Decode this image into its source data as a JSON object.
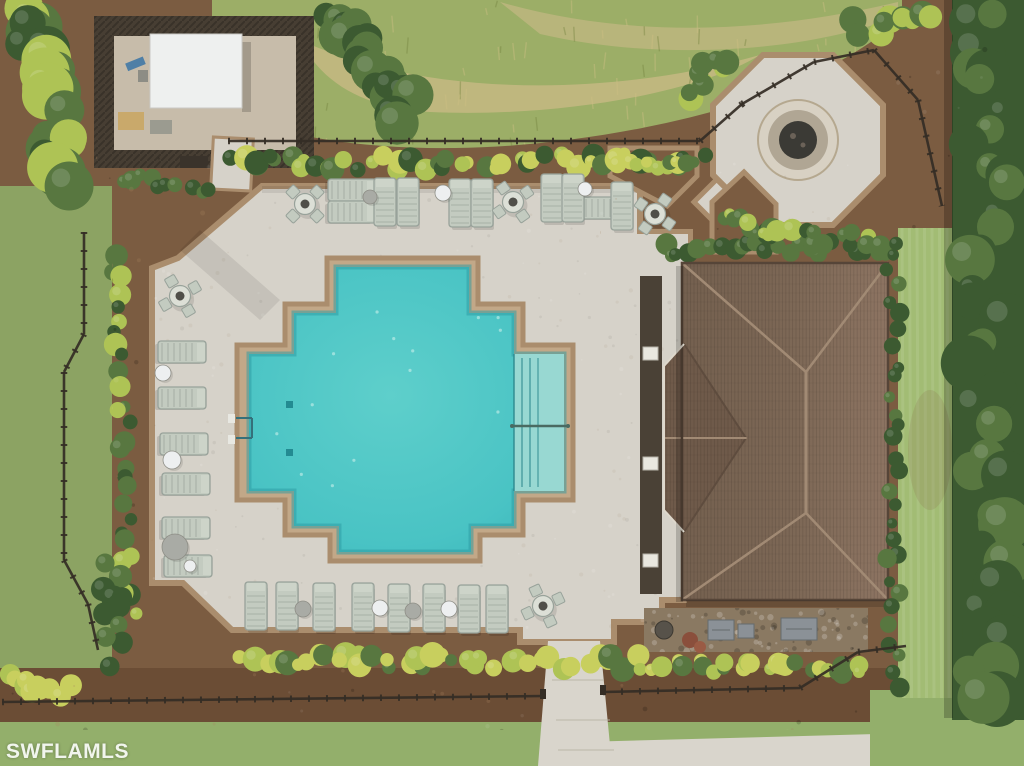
{
  "watermark": {
    "text": "SWFLAMLS"
  },
  "palette": {
    "mulch": "#7b5c41",
    "mulchDark": "#6b4d35",
    "grassField": "#9cae67",
    "grassBand": "#c8b985",
    "lawn": "#a2bc74",
    "grassBottom": "#93af6b",
    "leftGrass": "#8ca363",
    "hedgeDark": "#3c5a31",
    "hedgeMid": "#587740",
    "shrubBright": "#aec355",
    "shrubYellow": "#c8cf5e",
    "deck": "#d6d2c9",
    "deckBorder": "#aa8d6d",
    "coping": "#c2a888",
    "walk": "#d9d5cc",
    "water": "#46c0c2",
    "waterLight": "#5ecfcb",
    "waterDeep": "#3fbcbf",
    "waterEdge": "#2b9aa2",
    "steps": "#98d8d2",
    "roofL": "#75604f",
    "roofR": "#8d7462",
    "roofWing": "#6f5a4a",
    "roofLine": "#a18a74",
    "roofShadow": "#564538",
    "fence": "#342d25",
    "frame": "#98a29a",
    "slat": "#c3cbc0",
    "white": "#edeff0",
    "grayDisc": "#a9aba5",
    "gravel": "#c7bcaa",
    "enclosureFence": "#473e33",
    "structure": "#eef0ef",
    "rock": "#8a7962",
    "ac": "#8b9197",
    "firepitRing": "#d8d1c3",
    "firepitInner": "#3b3a35"
  },
  "palmColors": {
    "bright": [
      "#bcc959",
      "#96ad48"
    ],
    "mid": [
      "#8fae4c",
      "#6f9040"
    ],
    "dark": [
      "#70903f",
      "#587736"
    ]
  },
  "scene": {
    "leftLoungers": [
      {
        "x": 182,
        "y": 352
      },
      {
        "x": 182,
        "y": 398
      },
      {
        "x": 184,
        "y": 444
      },
      {
        "x": 186,
        "y": 484
      },
      {
        "x": 186,
        "y": 528
      },
      {
        "x": 188,
        "y": 566
      }
    ],
    "topLoungersH": [
      {
        "x": 352,
        "y": 190
      },
      {
        "x": 352,
        "y": 212
      },
      {
        "x": 600,
        "y": 208
      }
    ],
    "topLoungersV": [
      {
        "x": 385,
        "y": 202
      },
      {
        "x": 408,
        "y": 202
      },
      {
        "x": 460,
        "y": 203
      },
      {
        "x": 482,
        "y": 203
      },
      {
        "x": 552,
        "y": 198
      },
      {
        "x": 573,
        "y": 198
      },
      {
        "x": 622,
        "y": 206
      }
    ],
    "bottomLoungers": [
      {
        "x": 256,
        "y": 606
      },
      {
        "x": 287,
        "y": 606
      },
      {
        "x": 324,
        "y": 607
      },
      {
        "x": 363,
        "y": 607
      },
      {
        "x": 399,
        "y": 608
      },
      {
        "x": 434,
        "y": 608
      },
      {
        "x": 469,
        "y": 609
      },
      {
        "x": 497,
        "y": 609
      }
    ],
    "tableSets": [
      {
        "x": 180,
        "y": 296,
        "rot": 15
      },
      {
        "x": 305,
        "y": 204,
        "rot": 0
      },
      {
        "x": 513,
        "y": 202,
        "rot": 10
      },
      {
        "x": 655,
        "y": 214,
        "rot": -10
      },
      {
        "x": 543,
        "y": 606,
        "rot": 20
      }
    ],
    "discs": [
      {
        "x": 163,
        "y": 373,
        "r": 8,
        "c": "white"
      },
      {
        "x": 172,
        "y": 460,
        "r": 9,
        "c": "white"
      },
      {
        "x": 175,
        "y": 547,
        "r": 13,
        "c": "gray"
      },
      {
        "x": 370,
        "y": 197,
        "r": 7,
        "c": "gray"
      },
      {
        "x": 443,
        "y": 193,
        "r": 8,
        "c": "white"
      },
      {
        "x": 585,
        "y": 189,
        "r": 7,
        "c": "white"
      },
      {
        "x": 303,
        "y": 609,
        "r": 8,
        "c": "gray"
      },
      {
        "x": 380,
        "y": 608,
        "r": 8,
        "c": "white"
      },
      {
        "x": 413,
        "y": 611,
        "r": 8,
        "c": "gray"
      },
      {
        "x": 449,
        "y": 609,
        "r": 8,
        "c": "white"
      },
      {
        "x": 190,
        "y": 566,
        "r": 6,
        "c": "white"
      }
    ],
    "trash": [
      {
        "x": 243,
        "y": 182,
        "r": 9
      }
    ],
    "coolerBox": {
      "x": 174,
      "y": 608,
      "w": 13,
      "h": 13,
      "rot": 12
    },
    "firePit": {
      "cx": 798,
      "cy": 140,
      "chairs": [
        {
          "x": 768,
          "y": 102
        },
        {
          "x": 812,
          "y": 106
        },
        {
          "x": 748,
          "y": 131
        },
        {
          "x": 833,
          "y": 151
        },
        {
          "x": 760,
          "y": 168
        },
        {
          "x": 793,
          "y": 180
        }
      ]
    },
    "palms": [
      {
        "x": 40,
        "y": 70,
        "r": 115,
        "n": 10,
        "a0": -30,
        "a1": 140,
        "c": "bright"
      },
      {
        "x": 310,
        "y": 58,
        "r": 68,
        "n": 11,
        "c": "mid"
      },
      {
        "x": 468,
        "y": 60,
        "r": 72,
        "n": 11,
        "c": "mid"
      },
      {
        "x": 643,
        "y": 80,
        "r": 55,
        "n": 10,
        "c": "mid"
      },
      {
        "x": 405,
        "y": 100,
        "r": 38,
        "n": 8,
        "c": "bright"
      },
      {
        "x": 40,
        "y": 428,
        "r": 46,
        "n": 9,
        "c": "bright"
      },
      {
        "x": 90,
        "y": 436,
        "r": 40,
        "n": 8,
        "c": "mid"
      },
      {
        "x": 195,
        "y": 652,
        "r": 150,
        "n": 13,
        "c": "bright"
      },
      {
        "x": 610,
        "y": 760,
        "r": 135,
        "n": 9,
        "a0": 185,
        "a1": 355,
        "c": "bright"
      },
      {
        "x": 935,
        "y": 60,
        "r": 85,
        "n": 10,
        "c": "mid"
      },
      {
        "x": 1000,
        "y": 150,
        "r": 55,
        "n": 8,
        "c": "bright"
      },
      {
        "x": 870,
        "y": 20,
        "r": 55,
        "n": 8,
        "a0": 0,
        "a1": 200,
        "c": "bright"
      },
      {
        "x": 718,
        "y": 212,
        "r": 58,
        "n": 9,
        "c": "bright"
      },
      {
        "x": 962,
        "y": 330,
        "r": 48,
        "n": 9,
        "c": "dark"
      },
      {
        "x": 905,
        "y": 612,
        "r": 58,
        "n": 10,
        "c": "dark"
      },
      {
        "x": 963,
        "y": 690,
        "r": 72,
        "n": 11,
        "c": "mid"
      },
      {
        "x": 845,
        "y": 695,
        "r": 55,
        "n": 9,
        "c": "dark"
      },
      {
        "x": 700,
        "y": 706,
        "r": 60,
        "n": 9,
        "c": "mid"
      }
    ],
    "poolMarkers": [
      {
        "x": 402,
        "y": 262
      },
      {
        "x": 438,
        "y": 262
      },
      {
        "x": 302,
        "y": 309
      },
      {
        "x": 521,
        "y": 309
      },
      {
        "x": 248,
        "y": 358,
        "v": true
      },
      {
        "x": 248,
        "y": 489,
        "v": true
      },
      {
        "x": 568,
        "y": 357,
        "v": true
      },
      {
        "x": 568,
        "y": 489,
        "v": true
      },
      {
        "x": 326,
        "y": 556
      },
      {
        "x": 470,
        "y": 556
      }
    ],
    "hedgeRows": [
      {
        "layer": "deckEdge",
        "x1": 228,
        "y1": 164,
        "x2": 700,
        "y2": 160,
        "n": 48,
        "rmin": 6,
        "rmax": 13,
        "cols": [
          "bright",
          "mid",
          "dark",
          "yellow"
        ]
      },
      {
        "layer": "south",
        "x1": 238,
        "y1": 660,
        "x2": 642,
        "y2": 663,
        "n": 42,
        "rmin": 6,
        "rmax": 13,
        "cols": [
          "bright",
          "yellow",
          "mid"
        ]
      },
      {
        "layer": "deckEdge",
        "x1": 116,
        "y1": 258,
        "x2": 130,
        "y2": 612,
        "n": 30,
        "rmin": 6,
        "rmax": 12,
        "cols": [
          "mid",
          "dark",
          "bright"
        ]
      },
      {
        "layer": "deckEdge",
        "x1": 664,
        "y1": 250,
        "x2": 882,
        "y2": 247,
        "n": 24,
        "rmin": 6,
        "rmax": 11,
        "cols": [
          "dark",
          "mid"
        ]
      },
      {
        "layer": "south",
        "x1": 652,
        "y1": 666,
        "x2": 866,
        "y2": 669,
        "n": 26,
        "rmin": 6,
        "rmax": 11,
        "cols": [
          "bright",
          "yellow",
          "mid"
        ]
      },
      {
        "layer": "east",
        "x1": 893,
        "y1": 240,
        "x2": 893,
        "y2": 688,
        "n": 30,
        "rmin": 5,
        "rmax": 10,
        "cols": [
          "dark",
          "mid"
        ]
      },
      {
        "layer": "east",
        "x1": 988,
        "y1": 8,
        "x2": 988,
        "y2": 714,
        "n": 42,
        "rmin": 13,
        "rmax": 28,
        "cols": [
          "dark",
          "mid"
        ]
      },
      {
        "layer": "trees",
        "x1": 34,
        "y1": 8,
        "x2": 62,
        "y2": 182,
        "n": 24,
        "rmin": 12,
        "rmax": 26,
        "cols": [
          "dark",
          "mid",
          "bright"
        ]
      },
      {
        "layer": "trees",
        "x1": 330,
        "y1": 14,
        "x2": 408,
        "y2": 118,
        "n": 24,
        "rmin": 12,
        "rmax": 22,
        "cols": [
          "dark",
          "mid"
        ]
      },
      {
        "layer": "deckEdge",
        "x1": 688,
        "y1": 92,
        "x2": 724,
        "y2": 60,
        "n": 10,
        "rmin": 8,
        "rmax": 14,
        "cols": [
          "mid",
          "bright"
        ]
      },
      {
        "layer": "deckEdge",
        "x1": 762,
        "y1": 236,
        "x2": 884,
        "y2": 240,
        "n": 14,
        "rmin": 7,
        "rmax": 12,
        "cols": [
          "mid",
          "dark",
          "bright"
        ]
      },
      {
        "layer": "trees",
        "x1": 856,
        "y1": 28,
        "x2": 930,
        "y2": 20,
        "n": 10,
        "rmin": 8,
        "rmax": 14,
        "cols": [
          "mid",
          "bright"
        ]
      },
      {
        "layer": "south",
        "x1": 112,
        "y1": 568,
        "x2": 116,
        "y2": 660,
        "n": 12,
        "rmin": 8,
        "rmax": 14,
        "cols": [
          "dark",
          "mid"
        ]
      },
      {
        "layer": "south",
        "x1": 6,
        "y1": 678,
        "x2": 64,
        "y2": 692,
        "n": 10,
        "rmin": 7,
        "rmax": 12,
        "cols": [
          "bright",
          "yellow"
        ]
      },
      {
        "layer": "deckEdge",
        "x1": 622,
        "y1": 164,
        "x2": 690,
        "y2": 162,
        "n": 10,
        "rmin": 5,
        "rmax": 9,
        "cols": [
          "bright",
          "mid",
          "yellow"
        ]
      },
      {
        "layer": "deckEdge",
        "x1": 724,
        "y1": 214,
        "x2": 768,
        "y2": 232,
        "n": 10,
        "rmin": 5,
        "rmax": 9,
        "cols": [
          "mid",
          "bright"
        ]
      },
      {
        "layer": "deckEdge",
        "x1": 126,
        "y1": 176,
        "x2": 208,
        "y2": 190,
        "n": 10,
        "rmin": 6,
        "rmax": 10,
        "cols": [
          "mid",
          "dark"
        ]
      }
    ],
    "fences": [
      [
        228,
        141,
        700,
        141
      ],
      [
        700,
        141,
        742,
        104
      ],
      [
        742,
        104,
        814,
        62
      ],
      [
        814,
        62,
        874,
        50
      ],
      [
        874,
        50,
        918,
        100
      ],
      [
        918,
        100,
        942,
        206
      ],
      [
        84,
        232,
        84,
        334
      ],
      [
        84,
        334,
        64,
        372
      ],
      [
        64,
        372,
        64,
        560
      ],
      [
        64,
        560,
        88,
        604
      ],
      [
        88,
        604,
        98,
        650
      ],
      [
        2,
        702,
        543,
        696
      ],
      [
        603,
        692,
        800,
        688
      ],
      [
        800,
        688,
        858,
        652
      ],
      [
        858,
        652,
        906,
        646
      ]
    ],
    "gateposts": [
      [
        543,
        694
      ],
      [
        603,
        690
      ]
    ]
  }
}
